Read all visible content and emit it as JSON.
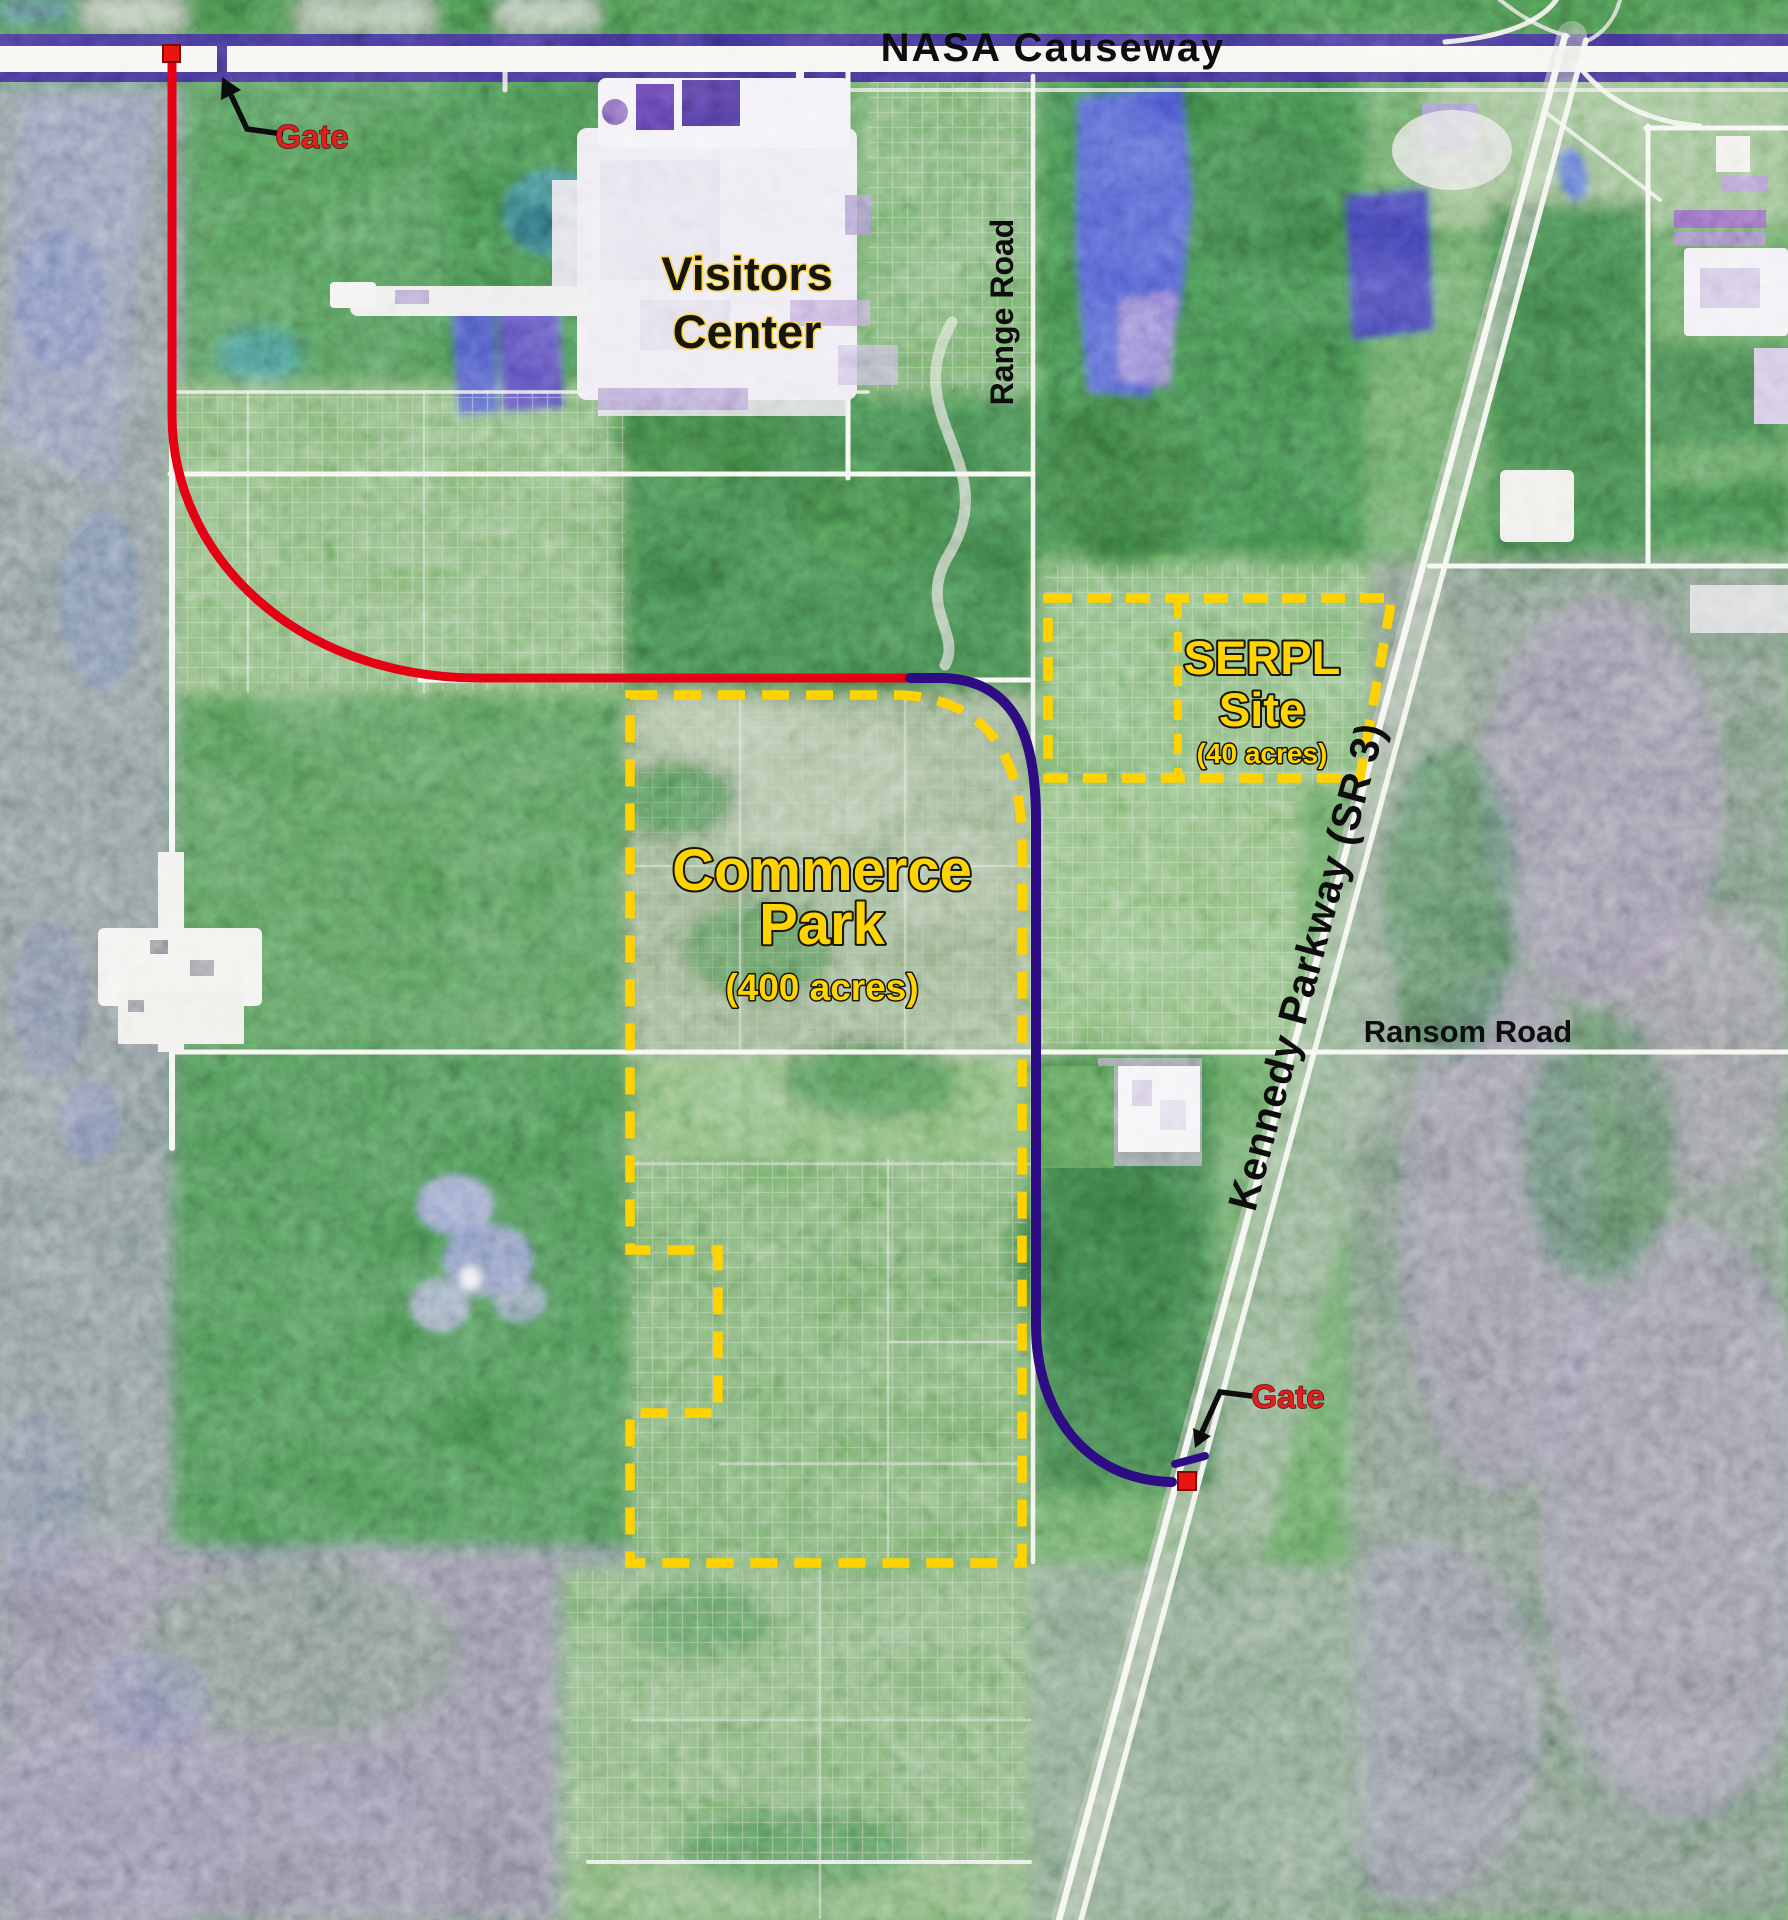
{
  "map": {
    "type": "annotated-satellite-map",
    "labels": {
      "nasa_causeway": "NASA Causeway",
      "gate_north": "Gate",
      "gate_south": "Gate",
      "visitors_center": {
        "line1": "Visitors",
        "line2": "Center"
      },
      "range_road": "Range Road",
      "kennedy_parkway": "Kennedy Parkway (SR 3)",
      "ransom_road": "Ransom Road",
      "serpl": {
        "line1": "SERPL",
        "line2": "Site",
        "acres": "(40 acres)"
      },
      "commerce_park": {
        "line1": "Commerce",
        "line2": "Park",
        "acres": "(400 acres)"
      }
    },
    "sites": [
      {
        "name": "Commerce Park",
        "acres_text": "(400 acres)",
        "boundary_style": "yellow-dashed"
      },
      {
        "name": "SERPL Site",
        "acres_text": "(40 acres)",
        "boundary_style": "yellow-dashed"
      }
    ],
    "markers": [
      {
        "id": "gate-north",
        "label": "Gate",
        "shape": "red-square",
        "location": "NASA Causeway west"
      },
      {
        "id": "gate-south",
        "label": "Gate",
        "shape": "red-square",
        "location": "Kennedy Parkway (SR 3)"
      }
    ],
    "routes": [
      {
        "id": "route-red",
        "color_key": "route_red"
      },
      {
        "id": "route-purple",
        "color_key": "route_purple"
      }
    ],
    "colors": {
      "boundary_yellow": "#ffd200",
      "route_red": "#e60014",
      "route_purple": "#2e0c84",
      "marker_red": "#ea1511",
      "label_red": "#e02020",
      "label_yellow": "#ffd400",
      "label_black": "#0d0d0d",
      "road_white": "#f2f3ec",
      "causeway_stripe": "#2a2070"
    }
  }
}
